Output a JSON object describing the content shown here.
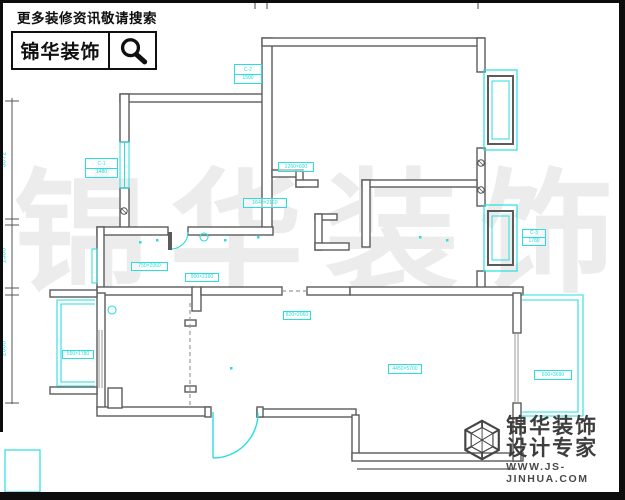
{
  "header": {
    "search_hint": "更多装修资讯敬请搜索",
    "brand": "锦华装饰"
  },
  "watermark": {
    "char1": "锦",
    "char2": "华",
    "char3": "装",
    "char4": "饰"
  },
  "plan": {
    "dim_left": {
      "seg1": "3072",
      "seg2": "1580",
      "seg3": "2000"
    },
    "colors": {
      "cyan": "#2adede",
      "wall": "#5b5b5b"
    },
    "labels": [
      {
        "row1": "C-2",
        "row2": "1500"
      },
      {
        "row1": "C-1",
        "row2": "1480"
      },
      {
        "row1": "2260×600"
      },
      {
        "row1": "1640×2160"
      },
      {
        "row1": "750×2060"
      },
      {
        "row1": "900×2160"
      },
      {
        "row1": "820×2060"
      },
      {
        "row1": "C-3",
        "row2": "1780"
      },
      {
        "row1": "550×1780"
      },
      {
        "row1": "4450×5700"
      },
      {
        "row1": "600×3690"
      }
    ]
  },
  "footer": {
    "brand": "锦华装饰",
    "tagline": "设计专家",
    "url": "WWW.JS-JINHUA.COM"
  }
}
